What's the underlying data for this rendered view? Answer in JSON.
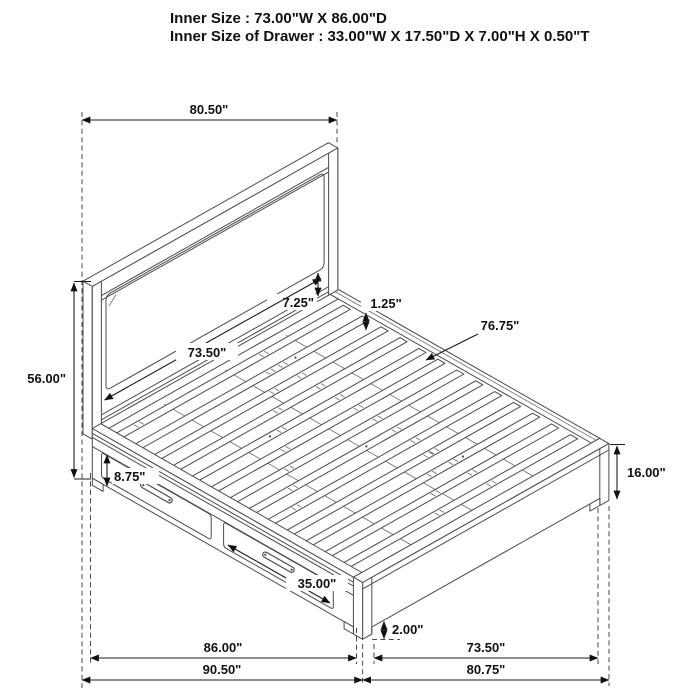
{
  "header": {
    "inner_size": "Inner Size : 73.00\"W X 86.00\"D",
    "drawer_size": "Inner Size of Drawer : 33.00\"W X 17.50\"D X 7.00\"H X 0.50\"T"
  },
  "dims": {
    "headboard_width": "80.50\"",
    "headboard_height": "56.00\"",
    "frame_bottom_rail": "7.25\"",
    "headboard_inner_width": "73.50\"",
    "slat_thickness": "1.25\"",
    "slat_length": "76.75\"",
    "rail_to_drawer": "8.75\"",
    "footboard_height": "16.00\"",
    "drawer_front_width": "35.00\"",
    "floor_clearance": "2.00\"",
    "inner_length": "86.00\"",
    "footboard_inner_width": "73.50\"",
    "overall_length": "90.50\"",
    "overall_width": "80.75\""
  }
}
